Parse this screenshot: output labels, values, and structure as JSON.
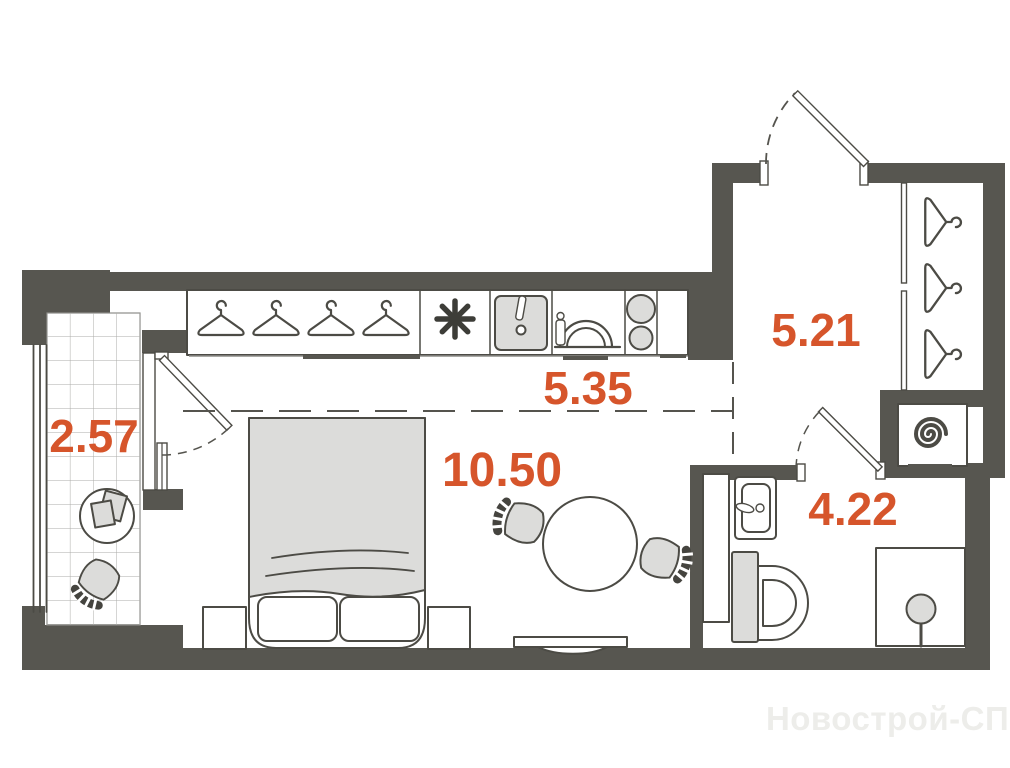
{
  "plan": {
    "type": "studio-apartment-floor-plan",
    "rooms": [
      {
        "id": "balcony",
        "area": "2.57"
      },
      {
        "id": "kitchen-zone",
        "area": "5.35"
      },
      {
        "id": "living-zone",
        "area": "10.50"
      },
      {
        "id": "hallway",
        "area": "5.21"
      },
      {
        "id": "bathroom",
        "area": "4.22"
      }
    ],
    "watermark": "Новострой-СПб",
    "colors": {
      "wall": "#575650",
      "outline": "#4c4b45",
      "light_fill": "#dcdcda",
      "label": "#d6552b",
      "watermark": "#ededea",
      "background": "#ffffff"
    },
    "icons": [
      "hanger-icon",
      "fridge-asterisk-icon",
      "kitchen-sink-icon",
      "dish-rack-icon",
      "stove-icon",
      "washing-machine-icon",
      "bathroom-sink-icon",
      "toilet-icon",
      "shower-icon",
      "bed",
      "dining-table-icon",
      "chair-icon",
      "door-swing-icon",
      "tv-icon",
      "balcony-table-icon"
    ]
  }
}
